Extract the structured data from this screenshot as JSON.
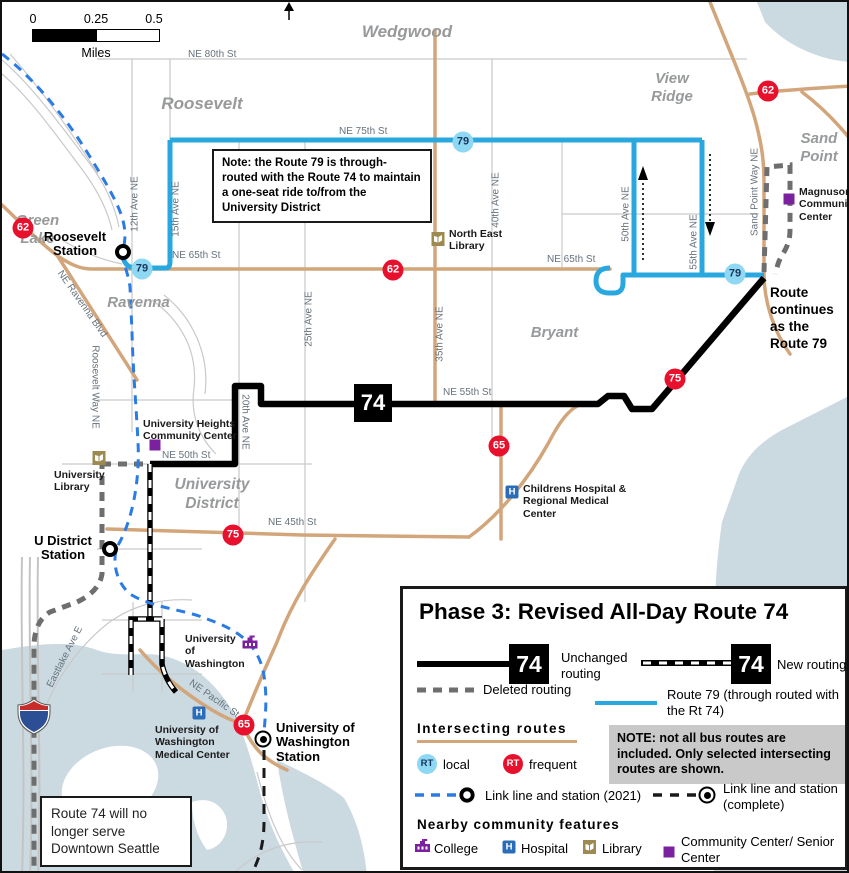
{
  "scale": {
    "t0": "0",
    "t1": "0.25",
    "t2": "0.5",
    "unit": "Miles"
  },
  "neighborhoods": {
    "wedgwood": "Wedgwood",
    "view_ridge": "View Ridge",
    "sand_point": "Sand Point",
    "roosevelt": "Roosevelt",
    "green_lake": "Green Lake",
    "ravenna": "Ravenna",
    "bryant": "Bryant",
    "university_district": "University District"
  },
  "streets": {
    "ne80": "NE 80th St",
    "ne75": "NE 75th St",
    "ne65": "NE 65th St",
    "ne55": "NE 55th St",
    "ne50": "NE 50th St",
    "ne45": "NE 45th St",
    "ne_pacific": "NE Pacific St",
    "ravenna_blvd": "NE Ravenna Blvd",
    "roosevelt_way": "Roosevelt Way NE",
    "eastlake": "Eastlake Ave E",
    "ave12": "12th Ave NE",
    "ave15": "15th Ave NE",
    "ave20": "20th Ave NE",
    "ave25": "25th Ave NE",
    "ave35": "35th Ave NE",
    "ave40": "40th Ave NE",
    "ave50": "50th Ave NE",
    "ave55": "55th Ave NE",
    "sand_point_way": "Sand Point Way NE"
  },
  "badges": {
    "b74": "74",
    "b79": "79",
    "b62": "62",
    "b75": "75",
    "b65": "65",
    "i5": "5",
    "rt": "RT",
    "hospital_glyph": "H"
  },
  "stations": {
    "roosevelt": "Roosevelt Station",
    "u_district": "U District Station",
    "uw": "University of Washington Station"
  },
  "features": {
    "magnuson": "Magnuson Community Center",
    "ne_library": "North East Library",
    "u_heights": "University Heights Community Center",
    "u_library": "University Library",
    "childrens": "Childrens Hospital & Regional Medical Center",
    "uw_campus": "University of Washington",
    "uw_med": "University of Washington Medical Center"
  },
  "notes": {
    "through_route": "Note: the Route 79 is through-routed with the Route 74 to maintain a one-seat ride to/from the University District",
    "continues": "Route continues as the Route 79",
    "downtown": "Route 74 will no longer serve Downtown Seattle"
  },
  "legend": {
    "title": "Phase 3: Revised All-Day Route 74",
    "unchanged": "Unchanged routing",
    "new_routing": "New routing",
    "deleted": "Deleted routing",
    "route79": "Route 79 (through routed with the Rt 74)",
    "intersecting": "Intersecting routes",
    "local": "local",
    "frequent": "frequent",
    "note": "NOTE:  not all bus routes are included. Only selected intersecting routes are shown.",
    "link2021": "Link line and station (2021)",
    "link_complete": "Link line and station (complete)",
    "community_heading": "Nearby community features",
    "college": "College",
    "hospital": "Hospital",
    "library": "Library",
    "community_center": "Community Center/ Senior Center"
  },
  "colors": {
    "route74": "#000000",
    "route79": "#29A8E0",
    "frequent_badge": "#E8112D",
    "local_badge": "#8FD8F3",
    "link2021": "#2B7BE4",
    "arterial_road": "#D2A57A",
    "water": "#CBD9E1",
    "deleted": "#6E6E6E",
    "community_purple": "#7B219F",
    "hospital_blue": "#2B6CB8"
  }
}
